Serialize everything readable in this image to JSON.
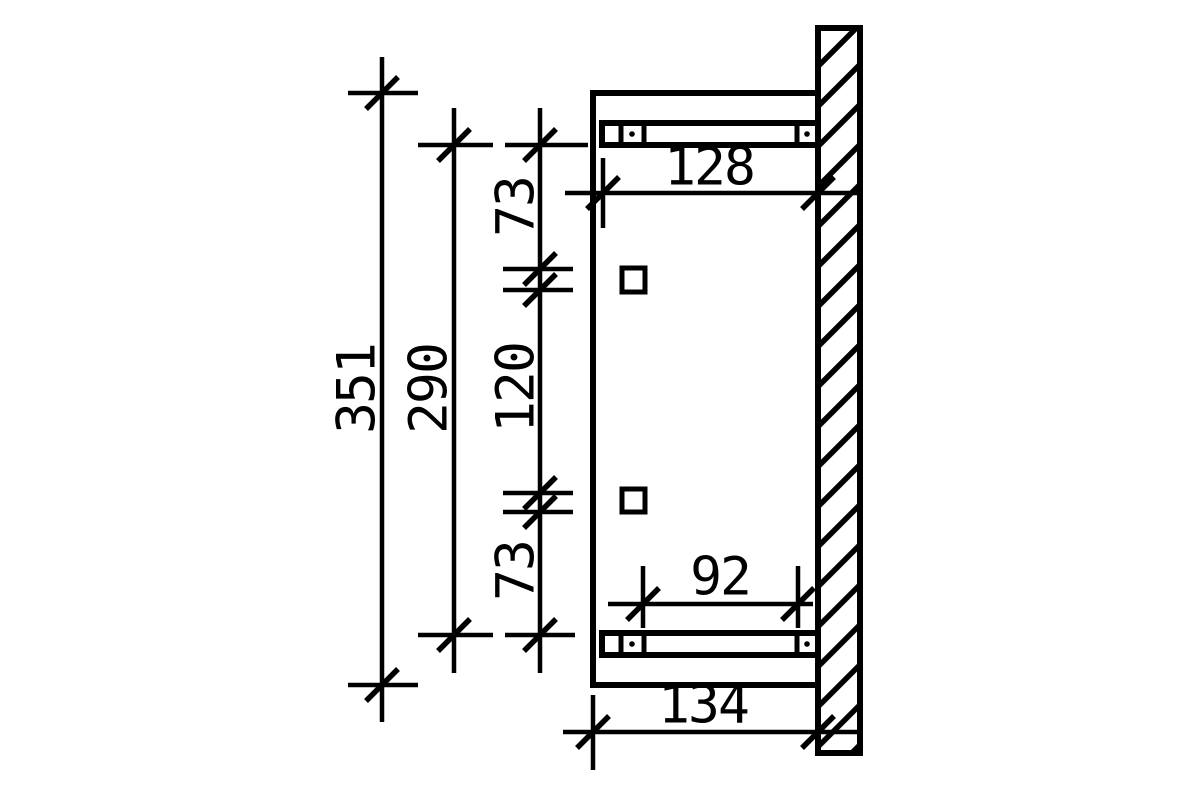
{
  "drawing": {
    "background_color": "#ffffff",
    "line_color": "#000000",
    "dims": {
      "total_height": "351",
      "bar_spacing": "290",
      "offset_top": "73",
      "hole_spacing": "120",
      "offset_bottom": "73",
      "bar_length_top": "128",
      "bar_inner_span": "92",
      "depth_bottom": "134"
    }
  }
}
